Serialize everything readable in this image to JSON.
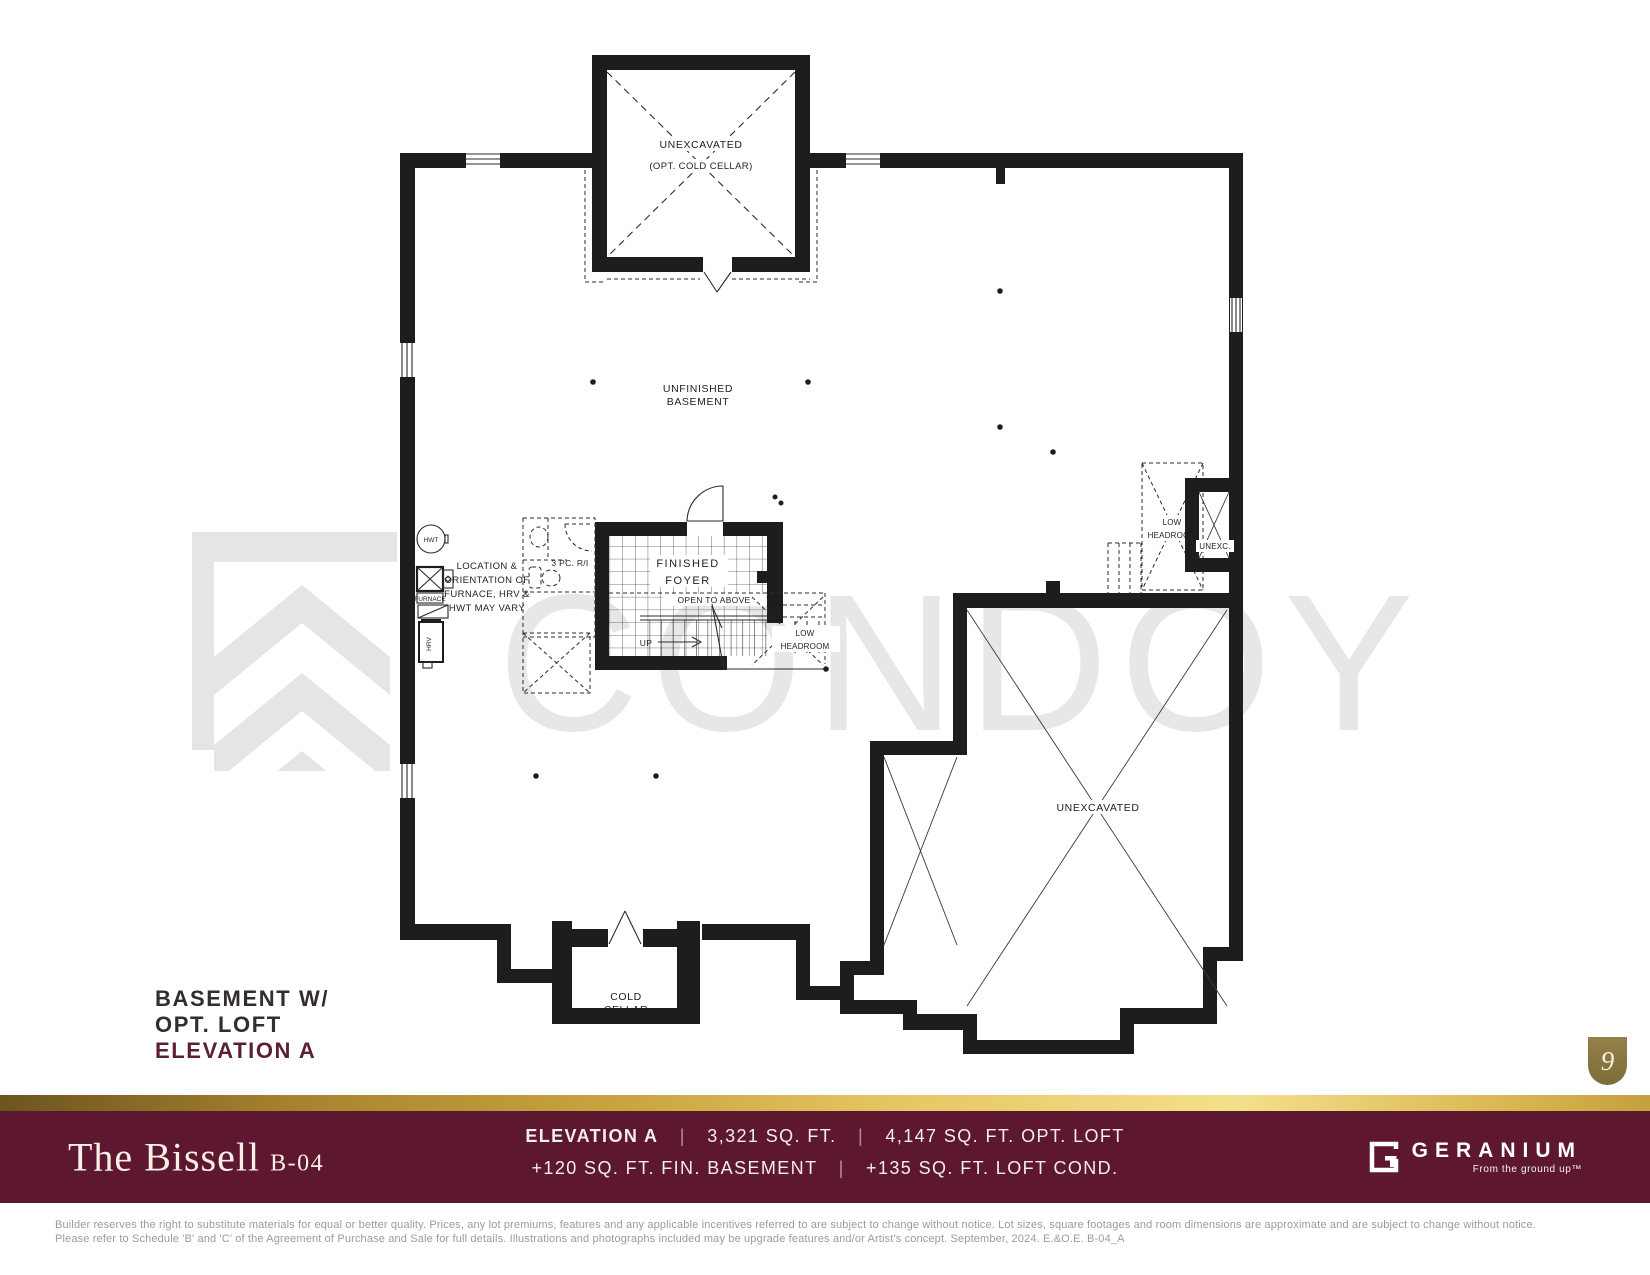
{
  "colors": {
    "wall": "#1d1d1d",
    "maroon": "#5E1731",
    "gold": "#CAA53F",
    "badge_gold": "#867343",
    "accent_label": "#5C2036",
    "watermark": "#E7E7E7"
  },
  "watermark": {
    "text": "CONDOY"
  },
  "plan": {
    "top_cellar": {
      "line1": "UNEXCAVATED",
      "line2": "(OPT. COLD CELLAR)"
    },
    "basement": {
      "line1": "UNFINISHED",
      "line2": "BASEMENT"
    },
    "foyer": {
      "line1": "FINISHED",
      "line2": "FOYER"
    },
    "open_to_above": "OPEN TO ABOVE",
    "up": "UP",
    "stair_headroom": {
      "line1": "LOW",
      "line2": "HEADROOM"
    },
    "right_headroom": {
      "line1": "LOW",
      "line2": "HEADROOM"
    },
    "unexc_small": "UNEXC.",
    "unexcavated": "UNEXCAVATED",
    "cold_cellar": {
      "line1": "COLD",
      "line2": "CELLAR"
    },
    "bath": "3 PC. R/I",
    "mech": {
      "hwt": "HWT",
      "furnace": "FURNACE",
      "hrv": "HRV",
      "note1": "LOCATION &",
      "note2": "ORIENTATION OF",
      "note3": "FURNACE, HRV &",
      "note4": "HWT MAY VARY"
    }
  },
  "plan_label": {
    "line1": "BASEMENT W/",
    "line2": "OPT. LOFT",
    "line3": "ELEVATION A"
  },
  "page_number": "9",
  "footer": {
    "title": "The Bissell",
    "model": "B-04",
    "specs_line1": {
      "a": "ELEVATION A",
      "sep": "|",
      "b": "3,321 SQ. FT.",
      "c": "4,147 SQ. FT. OPT. LOFT"
    },
    "specs_line2": {
      "a": "+120 SQ. FT. FIN. BASEMENT",
      "sep": "|",
      "b": "+135 SQ. FT. LOFT COND."
    },
    "brand": {
      "name": "GERANIUM",
      "tagline": "From the ground up™"
    },
    "disclaimer1": "Builder reserves the right to substitute materials for equal or better quality. Prices, any lot premiums, features and any applicable incentives referred to are subject to change without notice. Lot sizes, square footages and room dimensions are approximate and are subject to change without notice.",
    "disclaimer2": "Please refer to Schedule 'B' and 'C' of the Agreement of Purchase and Sale for full details. Illustrations and photographs included may be upgrade features and/or Artist's concept. September, 2024. E.&O.E. B-04_A"
  }
}
